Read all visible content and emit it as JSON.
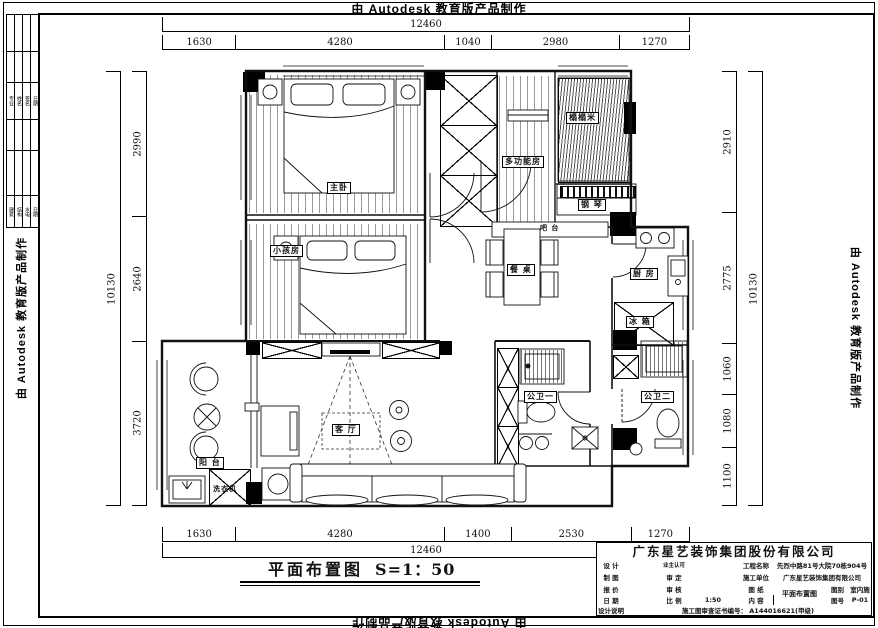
{
  "watermark": "由 Autodesk 教育版产品制作",
  "drawing_title": {
    "name": "平面布置图",
    "scale": "S=1：50"
  },
  "rooms": {
    "master_bedroom": "主卧",
    "kids_room": "小孩房",
    "multi_room": "多功能房",
    "tatami": "榻榻米",
    "piano": "钢 琴",
    "bar": "吧 台",
    "dining_table": "餐 桌",
    "kitchen": "厨 房",
    "fridge": "冰 箱",
    "living_room": "客 厅",
    "balcony": "阳 台",
    "washer": "洗衣机",
    "bath_1": "公卫一",
    "bath_2": "公卫二"
  },
  "dimensions": {
    "top": {
      "overall": "12460",
      "segments": [
        "1630",
        "4280",
        "1040",
        "2980",
        "1270"
      ]
    },
    "bottom": {
      "overall": "12460",
      "segments": [
        "1630",
        "4280",
        "1400",
        "2530",
        "1270"
      ]
    },
    "left": {
      "overall": "10130",
      "segments": [
        "2990",
        "2640",
        "3720"
      ]
    },
    "right": {
      "overall": "10130",
      "segments": [
        "2910",
        "2775",
        "1060",
        "1080",
        "1100"
      ]
    }
  },
  "title_block": {
    "company": "广东星艺装饰集团股份有限公司",
    "labels": {
      "design": "设 计",
      "draft": "制 图",
      "quote": "报 价",
      "date": "日 期",
      "owner": "业主认可",
      "approve": "审 定",
      "check": "审 核",
      "scale": "比 例",
      "project": "工程名称",
      "builder": "施工单位",
      "sheet": "图 纸",
      "content": "内 容",
      "sheet_type": "图别",
      "sheet_no": "图号",
      "notes": "设计说明"
    },
    "values": {
      "project": "先烈中路81号大院70栋904号",
      "builder": "广东星艺装饰集团有限公司",
      "drawing_content": "平面布置图",
      "sheet_type": "室内施",
      "sheet_no": "P-01",
      "scale": "1:50",
      "cert": "施工图审查证书编号：  A144016621(甲级)"
    }
  },
  "side_strip": {
    "a": [
      "专业",
      "姓名",
      "签名",
      "日期"
    ],
    "b": [
      "建筑",
      "结构",
      "水电",
      "日期"
    ]
  }
}
